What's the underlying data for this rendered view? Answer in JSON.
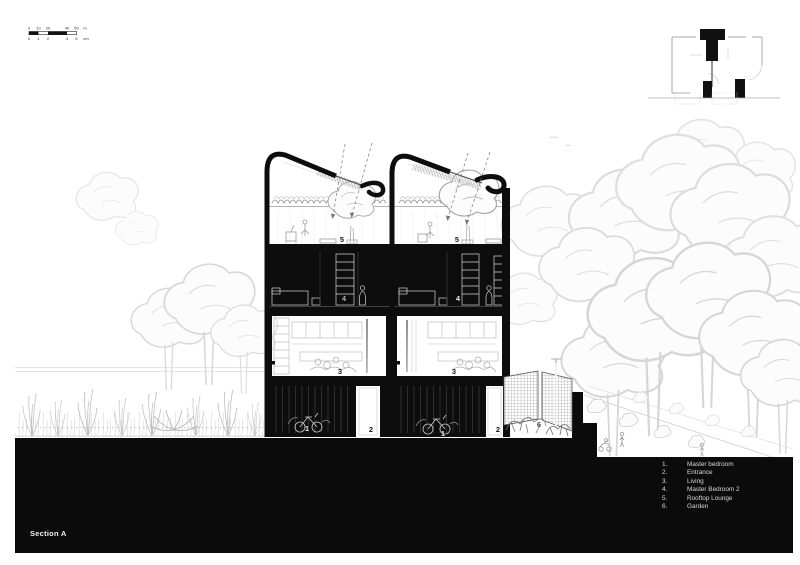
{
  "section": {
    "title": "Section A"
  },
  "scale_bar": {
    "m_ticks": [
      "0",
      "10",
      "20",
      "40",
      "50"
    ],
    "m_unit": "m",
    "cm_ticks": [
      "0",
      "1",
      "2",
      "4",
      "5"
    ],
    "cm_unit": "cm"
  },
  "legend": {
    "items": [
      {
        "num": "1.",
        "label": "Master bedroom"
      },
      {
        "num": "2.",
        "label": "Entrance"
      },
      {
        "num": "3.",
        "label": "Living"
      },
      {
        "num": "4.",
        "label": "Master Bedroom 2"
      },
      {
        "num": "5.",
        "label": "Rooftop Lounge"
      },
      {
        "num": "6.",
        "label": "Garden"
      }
    ]
  },
  "room_labels": {
    "master_bedroom": "1",
    "entrance": "2",
    "living": "3",
    "master_bedroom_2": "4",
    "rooftop_lounge": "5",
    "garden": "6"
  },
  "colors": {
    "ground_band": "#0b0b0b",
    "cut_wall": "#0d0d0d",
    "sketch_light": "#d6d6d6",
    "sketch_mid": "#9a9a9a",
    "label_on_dark": "#e8e8e8",
    "label_on_light": "#1a1a1a"
  }
}
